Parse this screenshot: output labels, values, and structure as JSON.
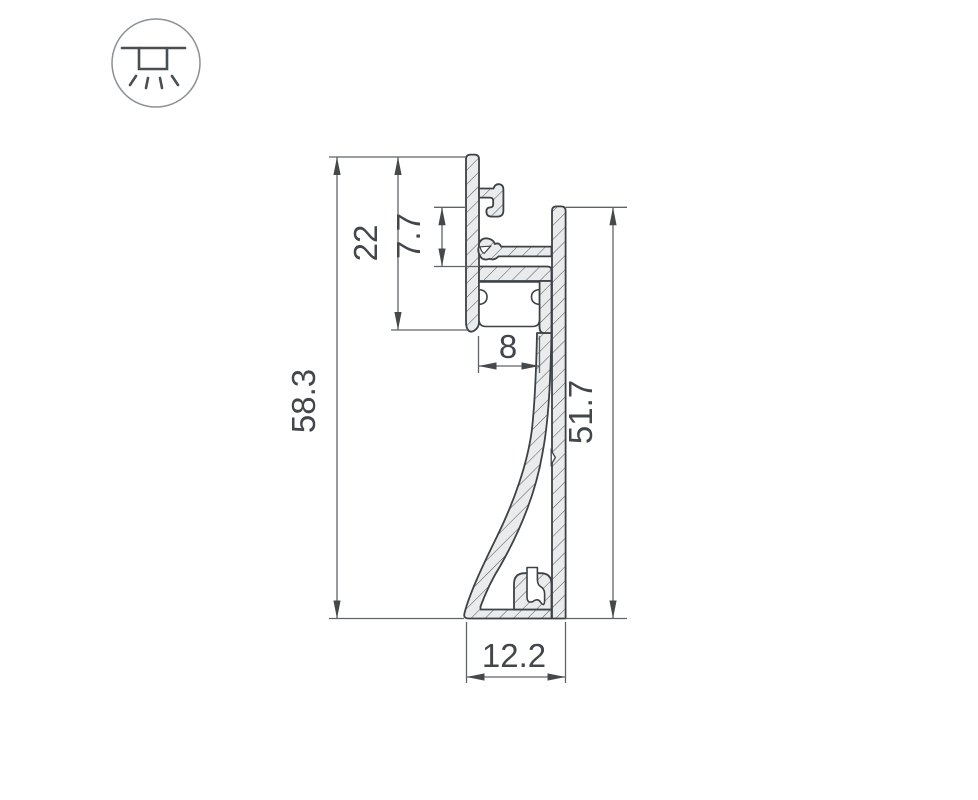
{
  "icon_badge": {
    "name": "recessed-light-icon"
  },
  "dimensions": {
    "total_height": {
      "label": "58.3"
    },
    "upper_section_height": {
      "label": "22"
    },
    "tongue_height": {
      "label": "7.7"
    },
    "led_slot_width": {
      "label": "8"
    },
    "wall_side_height": {
      "label": "51.7"
    },
    "base_width": {
      "label": "12.2"
    }
  },
  "colors": {
    "outline": "#3d4246",
    "material_fill": "#e9ebec",
    "hatch_line": "#555b5f",
    "dimension_line": "#5f6468",
    "dimension_text": "#43474b",
    "icon_circle": "#8b9094",
    "icon_symbol": "#4a4f53",
    "background": "#ffffff"
  }
}
